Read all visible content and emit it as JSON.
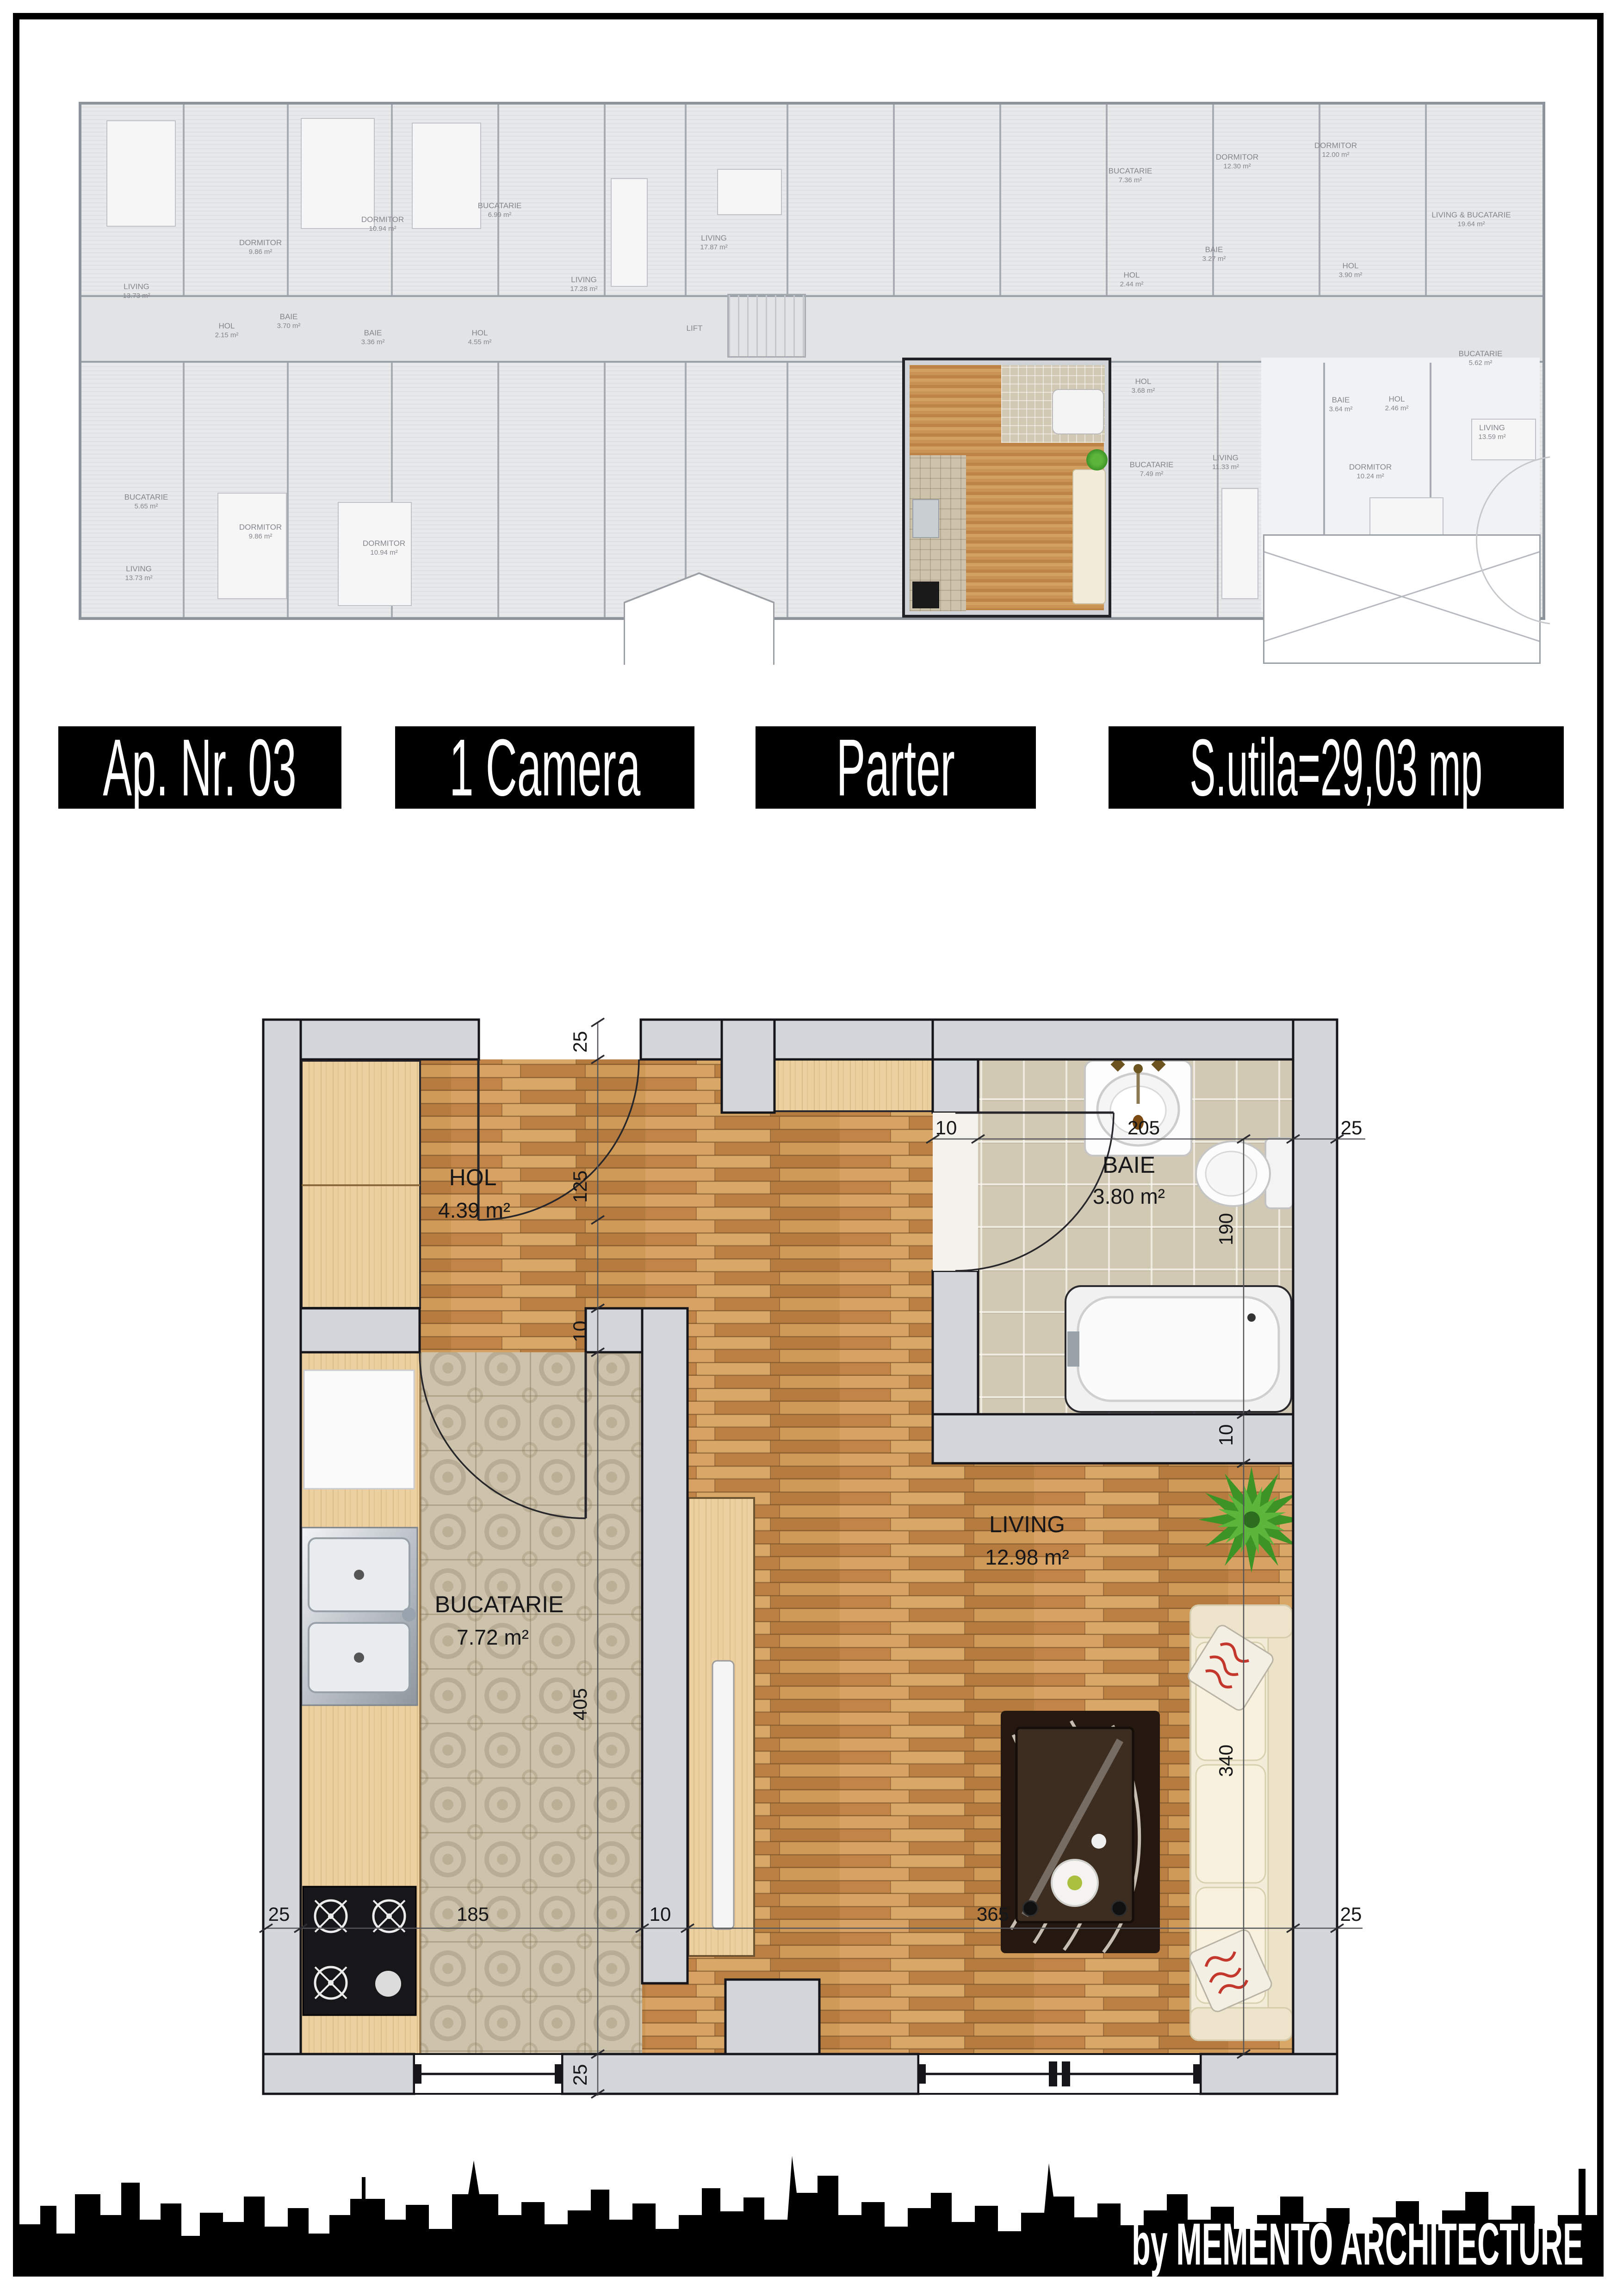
{
  "banner": {
    "apartment_no": "Ap. Nr. 03",
    "room_count": "1 Camera",
    "floor": "Parter",
    "usable_area": "S.utila=29,03 mp"
  },
  "attribution": "by MEMENTO ARCHITECTURE",
  "plan": {
    "rooms": [
      {
        "name": "HOL",
        "area": "4.39 m²"
      },
      {
        "name": "BAIE",
        "area": "3.80 m²"
      },
      {
        "name": "BUCATARIE",
        "area": "7.72 m²"
      },
      {
        "name": "LIVING",
        "area": "12.98 m²"
      }
    ],
    "dims": [
      "25",
      "125",
      "10",
      "405",
      "25",
      "185",
      "10",
      "365",
      "25",
      "205",
      "10",
      "25",
      "190",
      "10",
      "340",
      "25"
    ]
  },
  "overview": {
    "labels": [
      {
        "name": "LIVING",
        "area": "13.73 m²"
      },
      {
        "name": "DORMITOR",
        "area": "9.86 m²"
      },
      {
        "name": "DORMITOR",
        "area": "10.94 m²"
      },
      {
        "name": "BUCATARIE",
        "area": "6.99 m²"
      },
      {
        "name": "LIVING",
        "area": "17.28 m²"
      },
      {
        "name": "LIVING",
        "area": "17.87 m²"
      },
      {
        "name": "HOL",
        "area": "2.15 m²"
      },
      {
        "name": "BAIE",
        "area": "3.70 m²"
      },
      {
        "name": "BAIE",
        "area": "3.36 m²"
      },
      {
        "name": "HOL",
        "area": "4.55 m²"
      },
      {
        "name": "LIFT",
        "area": ""
      },
      {
        "name": "BUCATARIE",
        "area": "7.36 m²"
      },
      {
        "name": "DORMITOR",
        "area": "12.30 m²"
      },
      {
        "name": "DORMITOR",
        "area": "12.00 m²"
      },
      {
        "name": "LIVING & BUCATARIE",
        "area": "19.64 m²"
      },
      {
        "name": "HOL",
        "area": "2.44 m²"
      },
      {
        "name": "BAIE",
        "area": "3.27 m²"
      },
      {
        "name": "HOL",
        "area": "3.90 m²"
      },
      {
        "name": "BUCATARIE",
        "area": "5.62 m²"
      },
      {
        "name": "HOL",
        "area": "3.68 m²"
      },
      {
        "name": "BAIE",
        "area": "3.64 m²"
      },
      {
        "name": "HOL",
        "area": "2.46 m²"
      },
      {
        "name": "LIVING",
        "area": "11.33 m²"
      },
      {
        "name": "DORMITOR",
        "area": "10.24 m²"
      },
      {
        "name": "LIVING",
        "area": "13.59 m²"
      },
      {
        "name": "BUCATARIE",
        "area": "7.49 m²"
      },
      {
        "name": "BUCATARIE",
        "area": "5.65 m²"
      },
      {
        "name": "LIVING",
        "area": "13.73 m²"
      },
      {
        "name": "DORMITOR",
        "area": "9.86 m²"
      },
      {
        "name": "DORMITOR",
        "area": "10.94 m²"
      }
    ]
  },
  "colors": {
    "wood": "#c9904f",
    "kitchen_tile": "#cdc3ac",
    "bath_tile": "#d1c9b4",
    "wall_fill": "#d3d7dc",
    "banner_bg": "#000000",
    "banner_text": "#ffffff",
    "plant_green": "#3c9427",
    "pillow_red": "#c4372d"
  }
}
